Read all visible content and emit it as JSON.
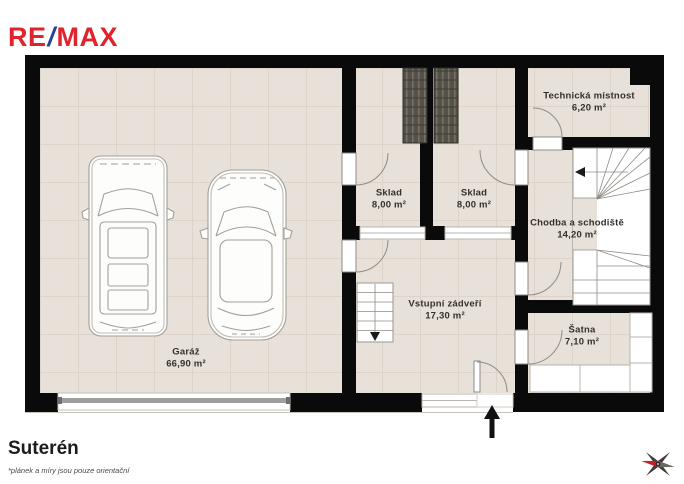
{
  "logo": {
    "re": "RE",
    "slash": "/",
    "max": "MAX"
  },
  "plan": {
    "rooms": [
      {
        "id": "garaz",
        "name": "Garáž",
        "area": "66,90 m²"
      },
      {
        "id": "sklad-1",
        "name": "Sklad",
        "area": "8,00 m²"
      },
      {
        "id": "sklad-2",
        "name": "Sklad",
        "area": "8,00 m²"
      },
      {
        "id": "vstupni",
        "name": "Vstupní zádveří",
        "area": "17,30 m²"
      },
      {
        "id": "technicka",
        "name": "Technická místnost",
        "area": "6,20 m²"
      },
      {
        "id": "chodba",
        "name": "Chodba a schodiště",
        "area": "14,20 m²"
      },
      {
        "id": "satna",
        "name": "Šatna",
        "area": "7,10 m²"
      }
    ]
  },
  "footer": {
    "title": "Suterén",
    "disclaimer": "*plánek a míry jsou pouze orientační"
  },
  "colors": {
    "brand_red": "#e0232c",
    "brand_blue": "#24439a",
    "wall": "#0a0a0a",
    "floor": "#e8e1d9",
    "compass_red": "#c32127"
  }
}
